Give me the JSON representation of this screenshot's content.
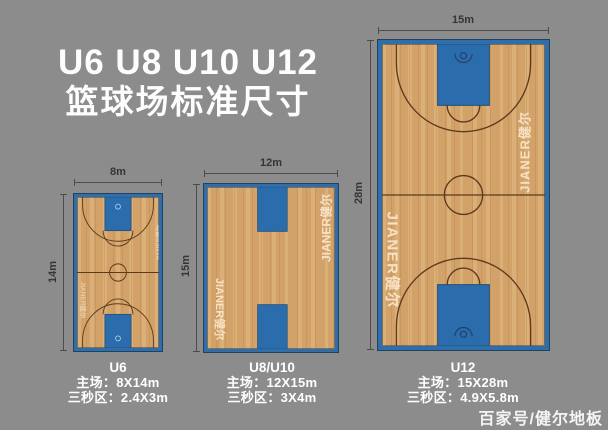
{
  "title": {
    "line1": "U6 U8 U10 U12",
    "line2": "篮球场标准尺寸"
  },
  "watermark": {
    "text": "JIANER健尔"
  },
  "credit": "百家号/健尔地板",
  "colors": {
    "background": "#8c8c8c",
    "court_wood": "#d6a76d",
    "court_blue": "#2a6cac",
    "border_blue": "#2f6ea8",
    "line_brown": "#5e3a1c",
    "dimension_text": "#353535",
    "text_white": "#ffffff"
  },
  "courts": [
    {
      "name": "U6",
      "width_label": "8m",
      "height_label": "14m",
      "caption": {
        "title": "U6",
        "line1": "主场：8X14m",
        "line2": "三秒区：2.4X3m"
      }
    },
    {
      "name": "U8/U10",
      "width_label": "12m",
      "height_label": "15m",
      "caption": {
        "title": "U8/U10",
        "line1": "主场：12X15m",
        "line2": "三秒区：3X4m"
      }
    },
    {
      "name": "U12",
      "width_label": "15m",
      "height_label": "28m",
      "caption": {
        "title": "U12",
        "line1": "主场：15X28m",
        "line2": "三秒区：4.9X5.8m"
      }
    }
  ]
}
